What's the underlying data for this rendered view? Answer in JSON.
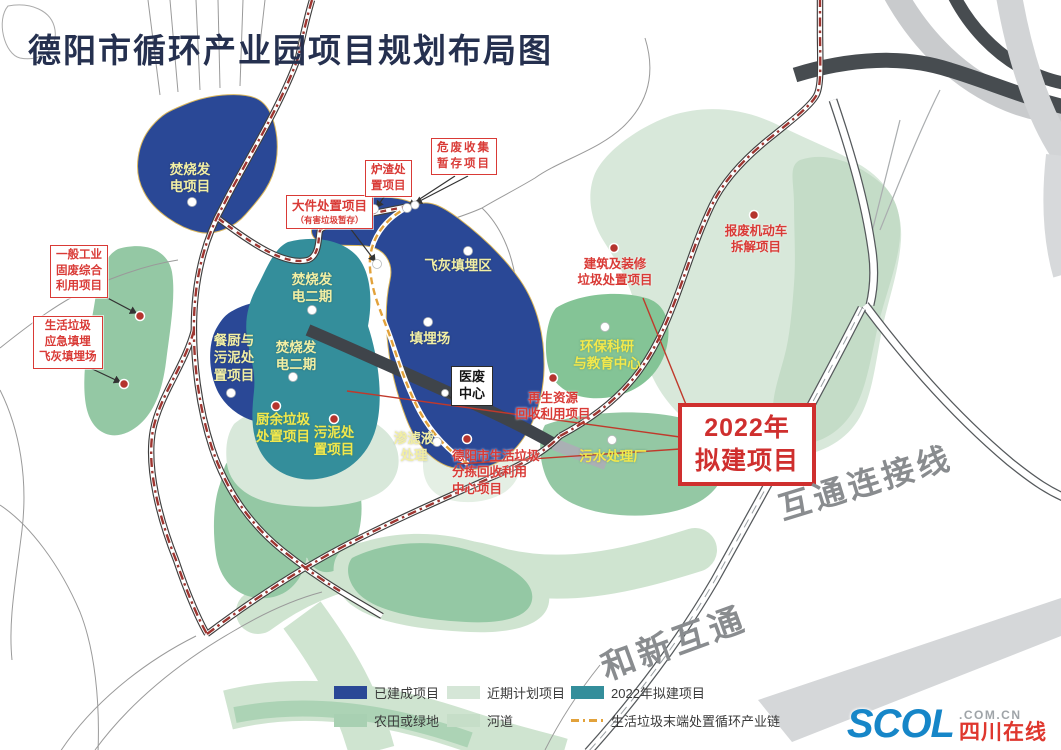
{
  "title": "德阳市循环产业园项目规划布局图",
  "colors": {
    "built-blue": "#2a4896",
    "teal-2022": "#348e9b",
    "near-term-green": "#d8e8da",
    "farm-green": "#94c8a4",
    "green-mid": "#84c496",
    "river-green": "#cfe4d0",
    "mint-green": "#c4dcc7",
    "pale-blob": "#e4efe4",
    "chain-red": "#9e3530",
    "chain-orange": "#e2a23b",
    "label-red": "#d93a36",
    "label-yellow": "#f2efa4",
    "label-yellow-bright": "#f2e84c",
    "title-navy": "#25304f",
    "road-dark": "#474c50",
    "road-light": "#c9cbcd",
    "gray-text": "#898c8f"
  },
  "area_labels": {
    "incineration_power": {
      "lines": [
        "焚烧发",
        "电项目"
      ]
    },
    "incineration_phase2_upper": {
      "lines": [
        "焚烧发",
        "电二期"
      ]
    },
    "incineration_phase2_lower": {
      "lines": [
        "焚烧发",
        "电二期"
      ]
    },
    "fly_ash": {
      "lines": [
        "飞灰填埋区"
      ]
    },
    "landfill": {
      "lines": [
        "填埋场"
      ]
    },
    "leachate": {
      "lines": [
        "渗滤液",
        "处理"
      ]
    },
    "kitchen_sludge": {
      "lines": [
        "餐厨与",
        "污泥处",
        "置项目"
      ]
    },
    "food_waste": {
      "lines": [
        "厨余垃圾",
        "处置项目"
      ]
    },
    "sludge": {
      "lines": [
        "污泥处",
        "置项目"
      ]
    },
    "env_research": {
      "lines": [
        "环保科研",
        "与教育中心"
      ]
    },
    "sewage_plant": {
      "lines": [
        "污水处理厂"
      ]
    }
  },
  "red_labels": {
    "renewable": {
      "lines": [
        "再生资源",
        "回收利用项目"
      ]
    },
    "construction": {
      "lines": [
        "建筑及装修",
        "垃圾处置项目"
      ]
    },
    "scrap_vehicle": {
      "lines": [
        "报废机动车",
        "拆解项目"
      ]
    },
    "sorting_center": {
      "lines": [
        "德阳市生活垃圾",
        "分拣回收利用",
        "中心项目"
      ]
    }
  },
  "boxed_labels": {
    "general_industrial": {
      "lines": [
        "一般工业",
        "固废综合",
        "利用项目"
      ]
    },
    "emergency_landfill": {
      "lines": [
        "生活垃圾",
        "应急填埋",
        "飞灰填埋场"
      ]
    },
    "bulky_waste": {
      "title": "大件处置项目",
      "sub": "（有害垃圾暂存）"
    },
    "slag": {
      "lines": [
        "炉渣处",
        "置项目"
      ]
    },
    "hazardous": {
      "lines": [
        "危废收集",
        "暂存项目"
      ]
    }
  },
  "callouts": {
    "y2022": {
      "lines": [
        "2022年",
        "拟建项目"
      ]
    },
    "medical": {
      "lines": [
        "医废",
        "中心"
      ]
    }
  },
  "road_names": {
    "interchange_link": "互通连接线",
    "hexin_interchange": "和新互通"
  },
  "legend": {
    "items": [
      {
        "type": "swatch",
        "color": "#2a4896",
        "label": "已建成项目"
      },
      {
        "type": "swatch",
        "color": "#d5e6d7",
        "label": "近期计划项目"
      },
      {
        "type": "swatch",
        "color": "#348e9b",
        "label": "2022年拟建项目"
      },
      {
        "type": "swatch",
        "color": "#a8d0b2",
        "label": "农田或绿地"
      },
      {
        "type": "swatch",
        "color": "#c6dec8",
        "label": "河道"
      },
      {
        "type": "dash",
        "color": "#e2a23b",
        "label": "生活垃圾末端处置循环产业链"
      }
    ]
  },
  "logo": {
    "name": "SCOL",
    "domain": ".COM.CN",
    "site": "四川在线"
  }
}
